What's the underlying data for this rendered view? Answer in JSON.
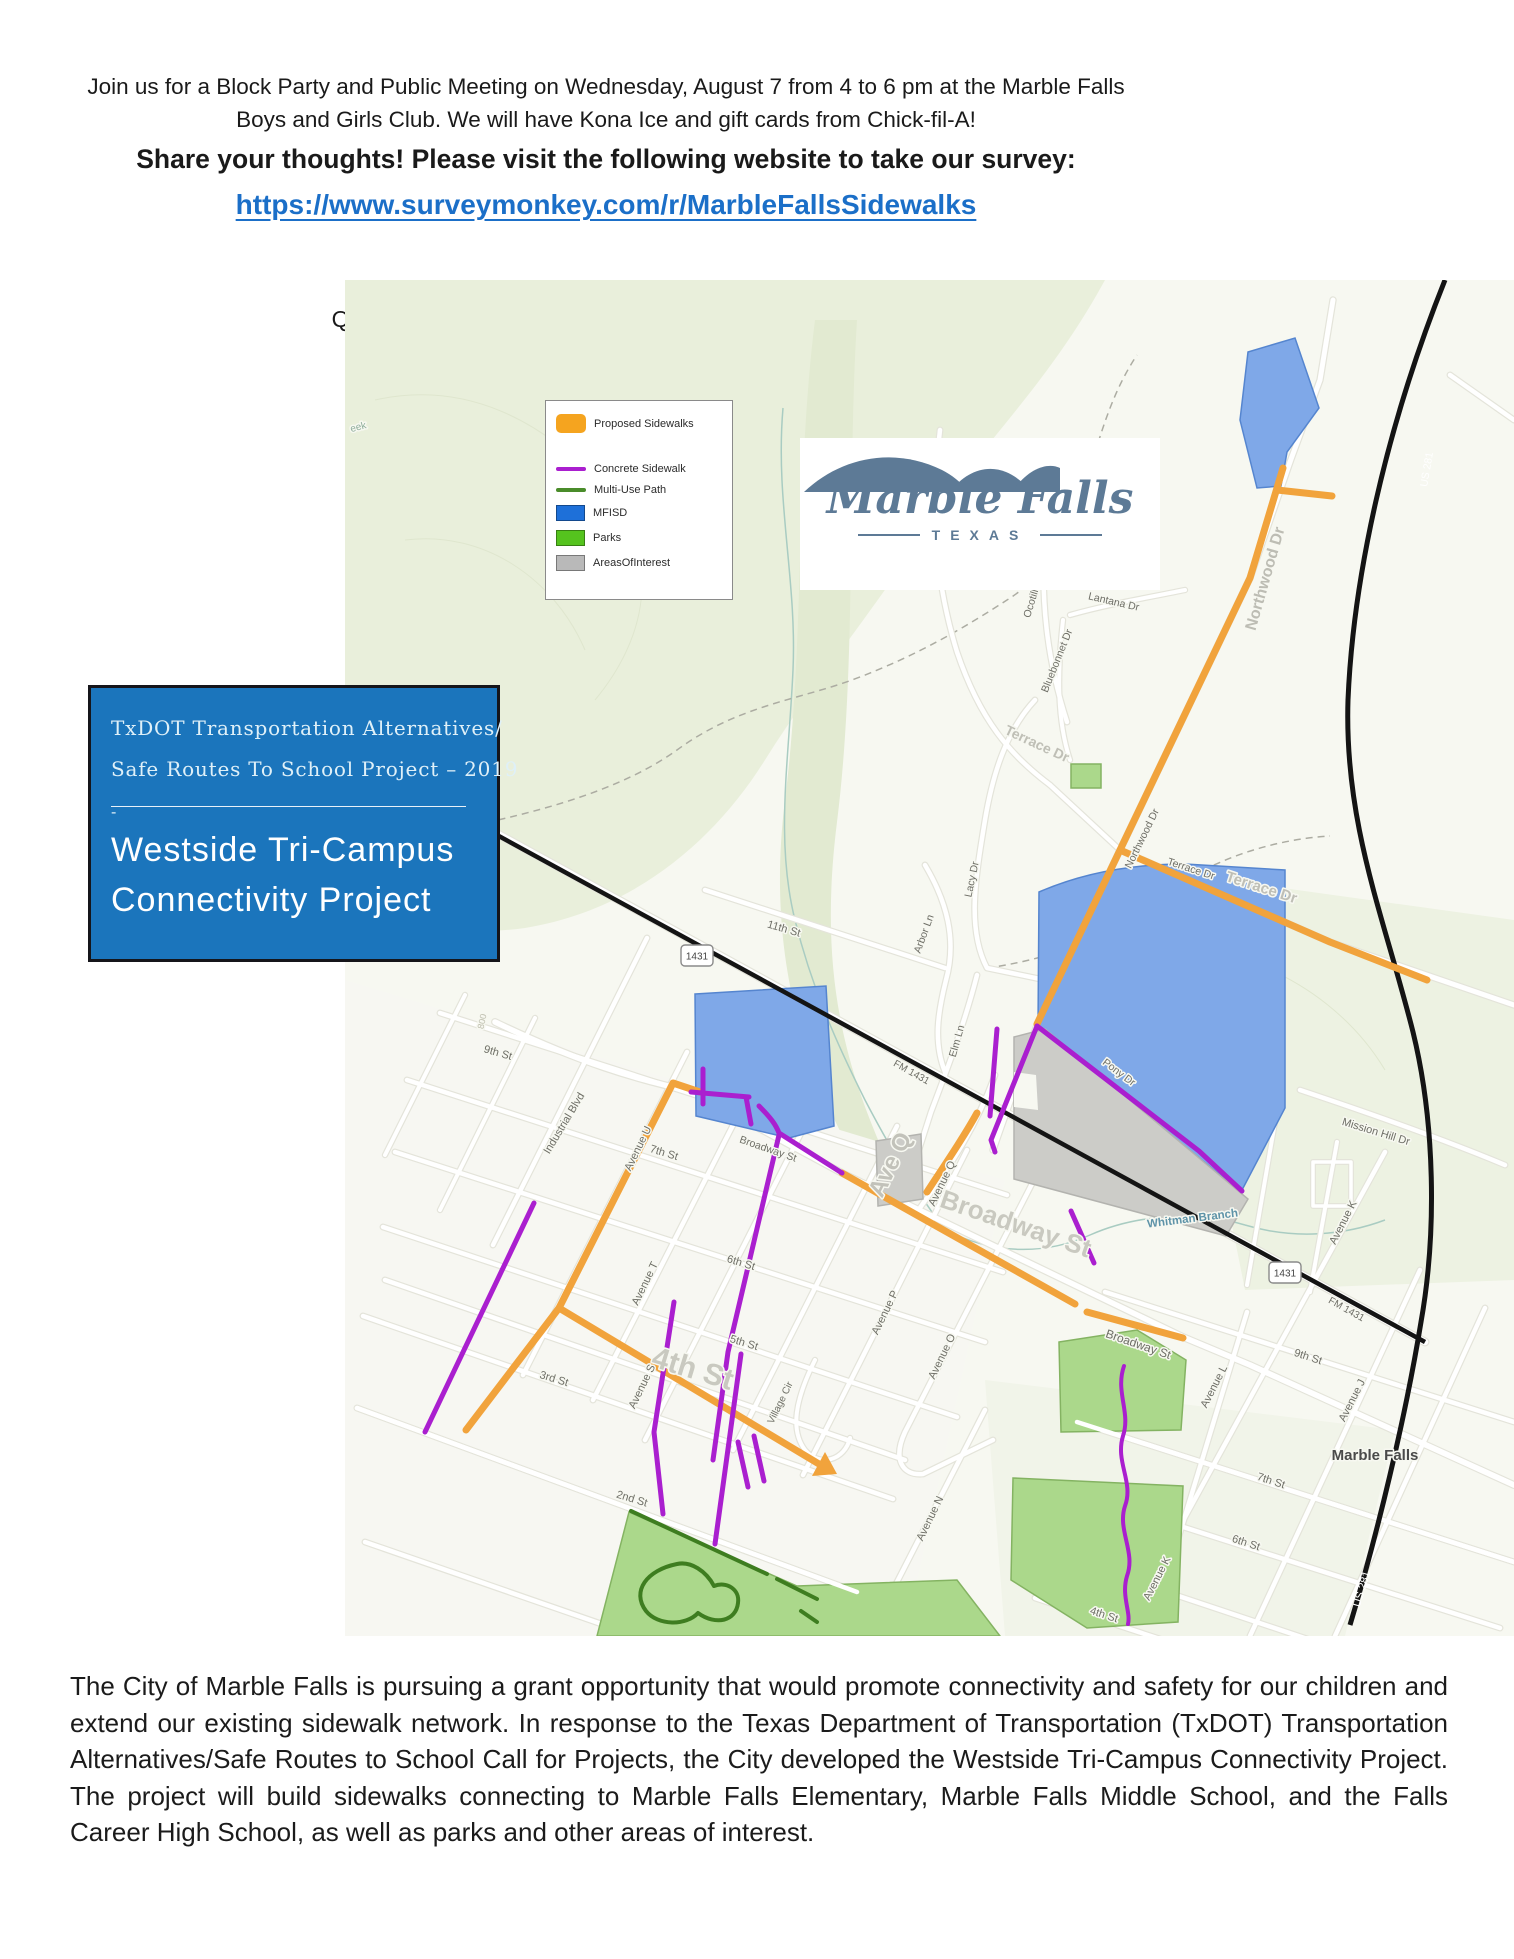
{
  "page": {
    "intro_line1": "Join us for a Block Party and Public Meeting on Wednesday, August 7 from 4 to 6 pm at the Marble Falls",
    "intro_line2": "Boys and Girls Club.  We will have Kona Ice and gift cards from Chick-fil-A!",
    "share_line": "Share your thoughts!  Please visit the following website to take our survey:",
    "survey_url": "https://www.surveymonkey.com/r/MarbleFallsSidewalks",
    "questions_prefix": "Questions?  Contact City Engineer Kacey Paul at ",
    "questions_email": "kpaul@marblefallstx.gov",
    "questions_suffix": ".",
    "body_paragraph": "The City of Marble Falls is pursuing a grant opportunity that would promote connectivity and safety for our children and extend our existing sidewalk network.  In response to the Texas Department of Transportation (TxDOT) Transportation Alternatives/Safe Routes to School Call for Projects, the City developed the Westside Tri-Campus Connectivity Project.  The project will build sidewalks connecting to Marble Falls Elementary, Marble Falls Middle School, and the Falls Career High School, as well as parks and other areas of interest."
  },
  "project_box": {
    "line1": "TxDOT Transportation Alternatives/",
    "line2": "Safe Routes To School Project – 2019",
    "divider_dash": "-",
    "title_line1": "Westside Tri-Campus",
    "title_line2": "Connectivity Project",
    "bg_color": "#1B75BC"
  },
  "logo": {
    "name": "Marble Falls",
    "subtitle": "TEXAS",
    "color": "#5D7A96"
  },
  "legend": {
    "items": [
      {
        "label": "Proposed Sidewalks",
        "swatch": "rect-round",
        "color": "#F5A41F"
      },
      {
        "label": "Concrete Sidewalk",
        "swatch": "line",
        "color": "#AA1FCF"
      },
      {
        "label": "Multi-Use Path",
        "swatch": "line",
        "color": "#4A8C2A"
      },
      {
        "label": "MFISD",
        "swatch": "rect",
        "color": "#1E70D9"
      },
      {
        "label": "Parks",
        "swatch": "rect",
        "color": "#55C31E"
      },
      {
        "label": "AreasOfInterest",
        "swatch": "rect",
        "color": "#B9B9B9"
      }
    ]
  },
  "map": {
    "colors": {
      "proposed": "#F1A33C",
      "concrete": "#AA1FCF",
      "multiuse": "#3E7D20",
      "mfisd_fill": "#7FA8E8",
      "mfisd_stroke": "#5585CF",
      "park_fill": "#ABD88B",
      "park_stroke": "#84B362",
      "aoi_fill": "#CCCCC8",
      "aoi_stroke": "#B3B3AF",
      "highway": "#141414"
    },
    "shields": [
      {
        "t": "1431",
        "x": 352,
        "y": 676
      },
      {
        "t": "1431",
        "x": 940,
        "y": 993
      }
    ],
    "labels": [
      {
        "t": "eek",
        "x": 14,
        "y": 150,
        "r": -15,
        "s": 10,
        "c": "#8FAE9C"
      },
      {
        "t": "800",
        "x": 140,
        "y": 742,
        "r": -78,
        "s": 9,
        "c": "#BDBDAD"
      },
      {
        "t": "11th St",
        "x": 438,
        "y": 652,
        "r": 16,
        "s": 11
      },
      {
        "t": "9th St",
        "x": 152,
        "y": 776,
        "r": 16,
        "s": 11
      },
      {
        "t": "7th St",
        "x": 318,
        "y": 876,
        "r": 17,
        "s": 11
      },
      {
        "t": "6th St",
        "x": 395,
        "y": 986,
        "r": 17,
        "s": 11
      },
      {
        "t": "5th St",
        "x": 398,
        "y": 1066,
        "r": 17,
        "s": 11
      },
      {
        "t": "3rd St",
        "x": 208,
        "y": 1102,
        "r": 17,
        "s": 11
      },
      {
        "t": "2nd St",
        "x": 286,
        "y": 1222,
        "r": 17,
        "s": 11
      },
      {
        "t": "4th St",
        "x": 345,
        "y": 1098,
        "r": 17,
        "s": 30,
        "c": "#C9C9C0",
        "w": "bold"
      },
      {
        "t": "Avenue U",
        "x": 296,
        "y": 870,
        "r": -64,
        "s": 11
      },
      {
        "t": "Avenue T",
        "x": 303,
        "y": 1005,
        "r": -64,
        "s": 11
      },
      {
        "t": "Avenue S",
        "x": 300,
        "y": 1108,
        "r": -64,
        "s": 11
      },
      {
        "t": "Village Cir",
        "x": 438,
        "y": 1124,
        "r": -64,
        "s": 10
      },
      {
        "t": "Avenue P",
        "x": 543,
        "y": 1034,
        "r": -64,
        "s": 11
      },
      {
        "t": "Avenue Q",
        "x": 600,
        "y": 905,
        "r": -64,
        "s": 11
      },
      {
        "t": "Ave Q",
        "x": 552,
        "y": 888,
        "r": -64,
        "s": 24,
        "c": "#C2C2BA",
        "w": "bold"
      },
      {
        "t": "Avenue O",
        "x": 600,
        "y": 1078,
        "r": -64,
        "s": 11
      },
      {
        "t": "Avenue N",
        "x": 588,
        "y": 1240,
        "r": -64,
        "s": 11
      },
      {
        "t": "Industrial Blvd",
        "x": 222,
        "y": 845,
        "r": -59,
        "s": 11
      },
      {
        "t": "Broadway St",
        "x": 422,
        "y": 872,
        "r": 19,
        "s": 10.5
      },
      {
        "t": "Broadway St",
        "x": 668,
        "y": 952,
        "r": 19,
        "s": 26,
        "c": "#C9C9C0",
        "w": "bold"
      },
      {
        "t": "Broadway St",
        "x": 792,
        "y": 1068,
        "r": 19,
        "s": 12
      },
      {
        "t": "Northwood Dr",
        "x": 925,
        "y": 300,
        "r": -74,
        "s": 16,
        "c": "#BDBDB4",
        "w": "bold"
      },
      {
        "t": "Northwood Dr",
        "x": 800,
        "y": 560,
        "r": -64,
        "s": 10.5
      },
      {
        "t": "Sunset Dr",
        "x": 585,
        "y": 272,
        "r": -73,
        "s": 10.5
      },
      {
        "t": "Ocotilla Dr",
        "x": 692,
        "y": 315,
        "r": -73,
        "s": 10.5
      },
      {
        "t": "Lantana Dr",
        "x": 768,
        "y": 325,
        "r": 13,
        "s": 10.5
      },
      {
        "t": "Bluebonnet Dr",
        "x": 715,
        "y": 382,
        "r": -68,
        "s": 10.5
      },
      {
        "t": "Terrace Dr",
        "x": 690,
        "y": 468,
        "r": 25,
        "s": 14,
        "c": "#BFBFB6",
        "w": "bold"
      },
      {
        "t": "Terrace Dr",
        "x": 915,
        "y": 612,
        "r": 18,
        "s": 15,
        "c": "#BFBFB6",
        "w": "bold"
      },
      {
        "t": "Terrace Dr",
        "x": 845,
        "y": 592,
        "r": 18,
        "s": 10.5
      },
      {
        "t": "Lacy Dr",
        "x": 630,
        "y": 600,
        "r": -78,
        "s": 10.5
      },
      {
        "t": "Arbor Ln",
        "x": 582,
        "y": 655,
        "r": -70,
        "s": 10.5
      },
      {
        "t": "Elm Ln",
        "x": 615,
        "y": 762,
        "r": -74,
        "s": 10.5
      },
      {
        "t": "Pony Dr",
        "x": 772,
        "y": 795,
        "r": 37,
        "s": 10.5
      },
      {
        "t": "FM 1431",
        "x": 565,
        "y": 795,
        "r": 29,
        "s": 10
      },
      {
        "t": "FM 1431",
        "x": 1000,
        "y": 1032,
        "r": 29,
        "s": 10
      },
      {
        "t": "Mission Hill Dr",
        "x": 1030,
        "y": 855,
        "r": 17,
        "s": 11
      },
      {
        "t": "Whitman Branch",
        "x": 848,
        "y": 942,
        "r": -7,
        "s": 11.5,
        "c": "#5E93A8",
        "w": "bold"
      },
      {
        "t": "Avenue K",
        "x": 1001,
        "y": 944,
        "r": -63,
        "s": 11
      },
      {
        "t": "Avenue L",
        "x": 872,
        "y": 1108,
        "r": -63,
        "s": 11
      },
      {
        "t": "9th St",
        "x": 962,
        "y": 1080,
        "r": 18,
        "s": 11
      },
      {
        "t": "Avenue J",
        "x": 1010,
        "y": 1122,
        "r": -63,
        "s": 11
      },
      {
        "t": "Marble Falls",
        "x": 1030,
        "y": 1180,
        "r": 0,
        "s": 15,
        "c": "#4A4A4A",
        "w": "600"
      },
      {
        "t": "7th St",
        "x": 925,
        "y": 1204,
        "r": 18,
        "s": 11
      },
      {
        "t": "6th St",
        "x": 900,
        "y": 1266,
        "r": 18,
        "s": 11
      },
      {
        "t": "Avenue K",
        "x": 815,
        "y": 1300,
        "r": -63,
        "s": 11
      },
      {
        "t": "4th St",
        "x": 758,
        "y": 1338,
        "r": 18,
        "s": 11
      },
      {
        "t": "US 281",
        "x": 1085,
        "y": 190,
        "r": -80,
        "s": 10.5,
        "c": "#FFFFFF",
        "h": 0
      },
      {
        "t": "US 281",
        "x": 1020,
        "y": 1310,
        "r": -73,
        "s": 11,
        "c": "#FFFFFF",
        "h": 0
      }
    ]
  }
}
